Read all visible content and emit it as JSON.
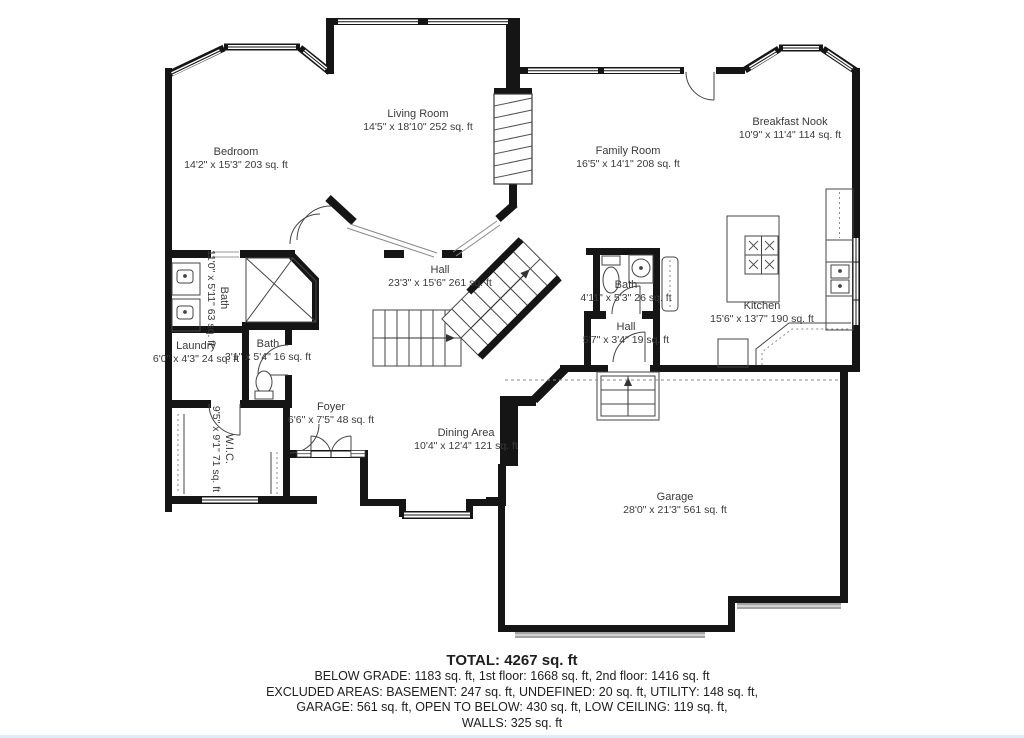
{
  "rooms": {
    "bedroom": {
      "name": "Bedroom",
      "dims": "14'2\" x 15'3\" 203 sq. ft"
    },
    "living": {
      "name": "Living Room",
      "dims": "14'5\" x 18'10\" 252 sq. ft"
    },
    "family": {
      "name": "Family Room",
      "dims": "16'5\" x 14'1\" 208 sq. ft"
    },
    "nook": {
      "name": "Breakfast Nook",
      "dims": "10'9\" x 11'4\" 114 sq. ft"
    },
    "hall_main": {
      "name": "Hall",
      "dims": "23'3\" x 15'6\" 261 sq. ft"
    },
    "bath_master": {
      "name": "Bath",
      "dims": "11'0\" x 5'11\" 63 sq. ft"
    },
    "bath_small": {
      "name": "Bath",
      "dims": "3'1\" x 5'4\" 16 sq. ft"
    },
    "laundry": {
      "name": "Laundry",
      "dims": "6'0\" x 4'3\" 24 sq. ft"
    },
    "wic": {
      "name": "W.I.C.",
      "dims": "9'5\" x 9'1\" 71 sq. ft"
    },
    "bath_family": {
      "name": "Bath",
      "dims": "4'11\" x 5'3\" 26 sq. ft"
    },
    "hall_small": {
      "name": "Hall",
      "dims": "5'7\" x 3'4\" 19 sq. ft"
    },
    "kitchen": {
      "name": "Kitchen",
      "dims": "15'6\" x 13'7\" 190 sq. ft"
    },
    "foyer": {
      "name": "Foyer",
      "dims": "6'6\" x 7'5\" 48 sq. ft"
    },
    "dining": {
      "name": "Dining Area",
      "dims": "10'4\" x 12'4\" 121 sq. ft"
    },
    "garage": {
      "name": "Garage",
      "dims": "28'0\" x 21'3\" 561 sq. ft"
    }
  },
  "summary": {
    "total": "TOTAL: 4267 sq. ft",
    "line1": "BELOW GRADE: 1183 sq. ft, 1st floor: 1668 sq. ft, 2nd floor: 1416 sq. ft",
    "line2": "EXCLUDED AREAS: BASEMENT: 247 sq. ft, UNDEFINED: 20 sq. ft, UTILITY: 148 sq. ft,",
    "line3": "GARAGE: 561 sq. ft, OPEN TO BELOW: 430 sq. ft, LOW CEILING: 119 sq. ft,",
    "line4": "WALLS: 325 sq. ft"
  },
  "colors": {
    "wall": "#151515",
    "thin_line": "#454545",
    "label_text": "#3a3a3a",
    "summary_text": "#1e1e1e",
    "garage_door": "#a3a3a3",
    "accent_bottom": "#cfe2f3"
  }
}
